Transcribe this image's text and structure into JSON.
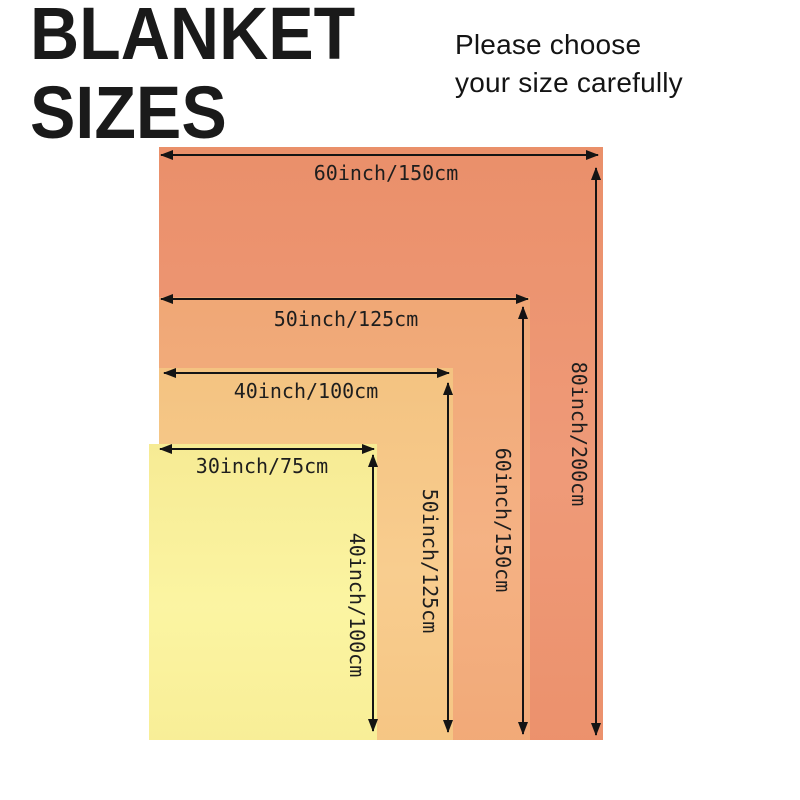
{
  "title": {
    "line1": "BLANKET",
    "line2": "SIZES"
  },
  "note": {
    "line1": "Please choose",
    "line2": "your size carefully"
  },
  "colors": {
    "line": "#141414",
    "text": "#1e1e1e",
    "background": "#ffffff"
  },
  "sizes": [
    {
      "name": "60x80 inch blanket",
      "width_label": "60inch/150cm",
      "height_label": "80inch/200cm",
      "color": "#ee9470"
    },
    {
      "name": "50x60 inch blanket",
      "width_label": "50inch/125cm",
      "height_label": "60inch/150cm",
      "color": "#f4ad7c"
    },
    {
      "name": "40x50 inch blanket",
      "width_label": "40inch/100cm",
      "height_label": "50inch/125cm",
      "color": "#f8ca88"
    },
    {
      "name": "30x40 inch blanket",
      "width_label": "30inch/75cm",
      "height_label": "40inch/100cm",
      "color": "#fbf49c"
    }
  ]
}
